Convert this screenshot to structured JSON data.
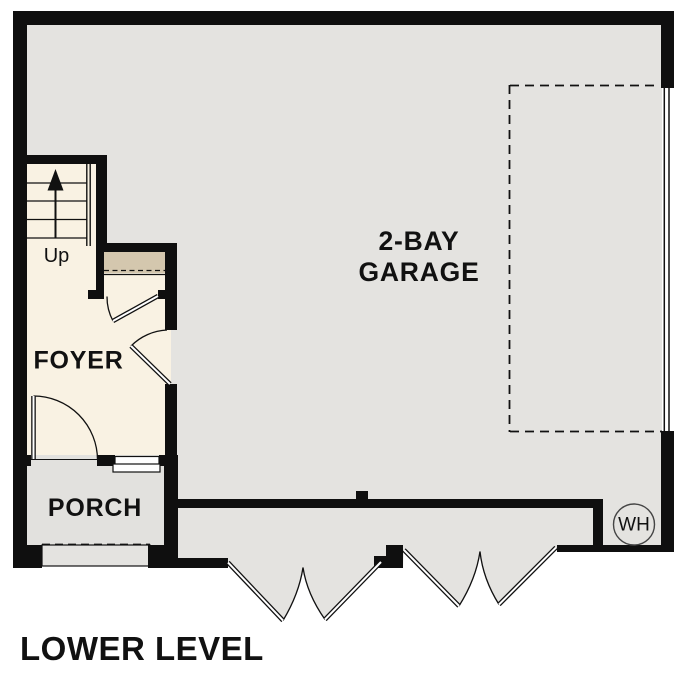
{
  "title": "LOWER LEVEL",
  "rooms": {
    "garage": {
      "label_line1": "2-BAY",
      "label_line2": "GARAGE"
    },
    "foyer": {
      "label": "FOYER"
    },
    "porch": {
      "label": "PORCH"
    }
  },
  "stairs": {
    "direction_label": "Up"
  },
  "fixtures": {
    "water_heater": {
      "label": "WH"
    }
  },
  "colors": {
    "wall": "#0f0f0f",
    "garage_floor": "#e4e3e0",
    "foyer_floor": "#f9f2e3",
    "closet_shelf": "#d4c7ae",
    "porch_floor": "#e2e1de",
    "step_floor": "#e4e3e0",
    "water_heater_fill": "#e4e3e0"
  }
}
